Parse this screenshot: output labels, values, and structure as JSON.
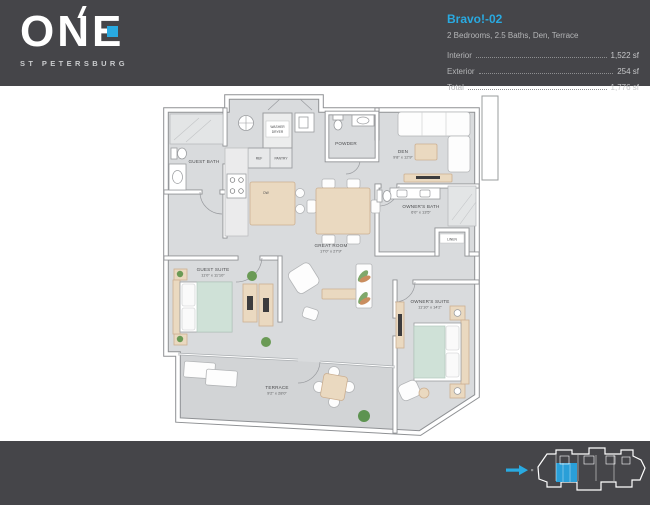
{
  "header": {
    "brand": {
      "name": "ONE",
      "subtitle": "ST PETERSBURG"
    },
    "unit": {
      "name": "Bravo!-02",
      "summary": "2 Bedrooms, 2.5 Baths, Den, Terrace",
      "areas": [
        {
          "label": "Interior",
          "value": "1,522 sf"
        },
        {
          "label": "Exterior",
          "value": "254 sf"
        },
        {
          "label": "Total",
          "value": "1,776 sf"
        }
      ]
    }
  },
  "floorplan": {
    "labels": {
      "guest_bath": "GUEST BATH",
      "powder": "POWDER",
      "washer_line1": "WASHER",
      "washer_line2": "DRYER",
      "ref": "REF",
      "pantry": "PANTRY",
      "dw": "DW",
      "linen": "LINEN",
      "den_name": "DEN",
      "den_dims": "9'8\" x 12'9\"",
      "owners_bath_name": "OWNER'S BATH",
      "owners_bath_dims": "6'0\" x 13'5\"",
      "great_room_name": "GREAT ROOM",
      "great_room_dims": "17'0\" x 27'9\"",
      "guest_suite_name": "GUEST SUITE",
      "guest_suite_dims": "11'0\" x 11'10\"",
      "owners_suite_name": "OWNER'S SUITE",
      "owners_suite_dims": "11'10\" x 14'2\"",
      "terrace_name": "TERRACE",
      "terrace_dims": "9'2\" x 28'0\""
    }
  },
  "colors": {
    "accent": "#29aae1",
    "band": "#454549",
    "unit_highlight": "#2a9fd8",
    "floor": "#d9dbdd"
  }
}
